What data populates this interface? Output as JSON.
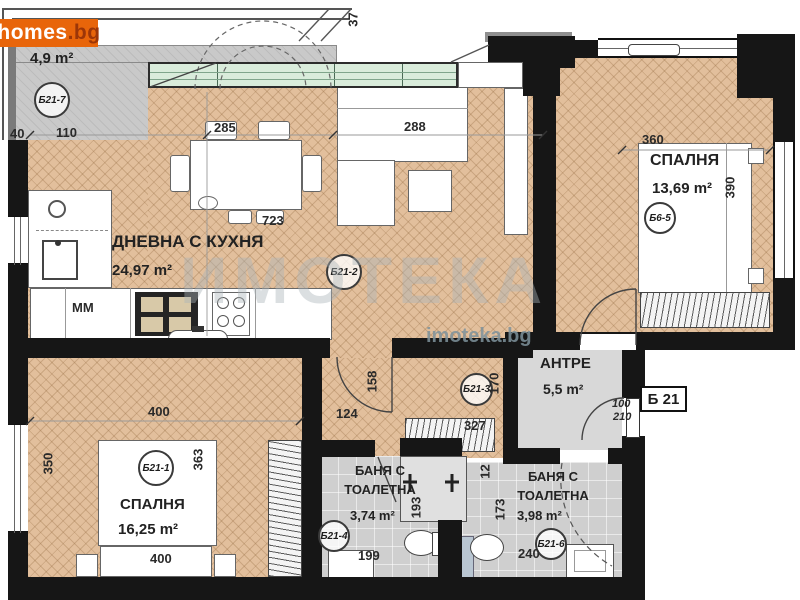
{
  "logo": {
    "text": "homes",
    "suffix": ".bg"
  },
  "watermark": {
    "big": "ИМОТЕКА",
    "site": "imoteka.bg"
  },
  "unit": {
    "label": "Б 21"
  },
  "rooms": {
    "living": {
      "name": "ДНЕВНА С КУХНЯ",
      "area": "24,97 m²",
      "code": "Б21-2"
    },
    "bedroom1": {
      "name": "СПАЛНЯ",
      "area": "13,69 m²",
      "code": "Б6-5"
    },
    "bedroom2": {
      "name": "СПАЛНЯ",
      "area": "16,25 m²",
      "code": "Б21-1"
    },
    "hall": {
      "name": "АНТРЕ",
      "area": "5,5 m²",
      "code": "Б21-3"
    },
    "bath1": {
      "name": "БАНЯ С ТОАЛЕТНА",
      "area": "3,74 m²",
      "code": "Б21-4"
    },
    "bath2": {
      "name": "БАНЯ С ТОАЛЕТНА",
      "area": "3,98 m²",
      "code": "Б21-6"
    },
    "terrace": {
      "area": "4,9 m²",
      "code": "Б21-7"
    }
  },
  "labels": {
    "mm": "MM"
  },
  "dims": {
    "roof": "37",
    "terrace_a": "40",
    "terrace_b": "110",
    "glazing": "285",
    "sofa": "288",
    "bed1_w": "360",
    "bed1_d": "390",
    "table": "723",
    "bed2_w": "400",
    "bed2_l": "350",
    "bed2_r": "363",
    "bed2_bed": "400",
    "corr_w": "124",
    "corr_d": "158",
    "hall_w": "327",
    "hall_d": "170",
    "entry_w": "100",
    "entry_h": "210",
    "bath1_w": "199",
    "bath1_d": "193",
    "bath2_d": "173",
    "bath2_o": "12",
    "bath2_w": "240"
  }
}
